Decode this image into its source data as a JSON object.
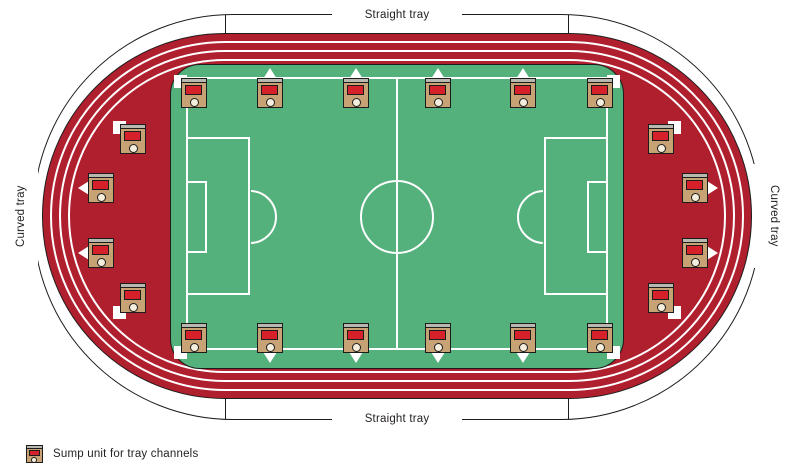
{
  "diagram": {
    "labels": {
      "straight_tray_top": "Straight tray",
      "straight_tray_bottom": "Straight tray",
      "curved_tray_left": "Curved tray",
      "curved_tray_right": "Curved tray"
    },
    "legend": {
      "sump_label": "Sump unit for tray channels"
    },
    "colors": {
      "track_red": "#b01f2e",
      "field_green": "#54b17c",
      "sump_body_tan": "#c6a274",
      "sump_panel_red": "#d6202a",
      "sump_lid_grey": "#b9b8ae",
      "sump_outlet_cream": "#f6eedd",
      "pitch_line_white": "#ffffff",
      "outline_black": "#1c1c1c"
    },
    "sump_units": [
      {
        "x": 181,
        "y": 78,
        "marker": "sq-tl"
      },
      {
        "x": 257,
        "y": 78,
        "marker": "tri-up"
      },
      {
        "x": 343,
        "y": 78,
        "marker": "tri-up"
      },
      {
        "x": 425,
        "y": 78,
        "marker": "tri-up"
      },
      {
        "x": 510,
        "y": 78,
        "marker": "tri-up"
      },
      {
        "x": 587,
        "y": 78,
        "marker": "sq-tr"
      },
      {
        "x": 181,
        "y": 323,
        "marker": "sq-bl"
      },
      {
        "x": 257,
        "y": 323,
        "marker": "tri-down"
      },
      {
        "x": 343,
        "y": 323,
        "marker": "tri-down"
      },
      {
        "x": 425,
        "y": 323,
        "marker": "tri-down"
      },
      {
        "x": 510,
        "y": 323,
        "marker": "tri-down"
      },
      {
        "x": 587,
        "y": 323,
        "marker": "sq-br"
      },
      {
        "x": 120,
        "y": 124,
        "marker": "sq-tl"
      },
      {
        "x": 88,
        "y": 173,
        "marker": "tri-left"
      },
      {
        "x": 88,
        "y": 238,
        "marker": "tri-left"
      },
      {
        "x": 120,
        "y": 283,
        "marker": "sq-bl"
      },
      {
        "x": 648,
        "y": 124,
        "marker": "sq-tr"
      },
      {
        "x": 682,
        "y": 173,
        "marker": "tri-right"
      },
      {
        "x": 682,
        "y": 238,
        "marker": "tri-right"
      },
      {
        "x": 648,
        "y": 283,
        "marker": "sq-br"
      }
    ]
  }
}
